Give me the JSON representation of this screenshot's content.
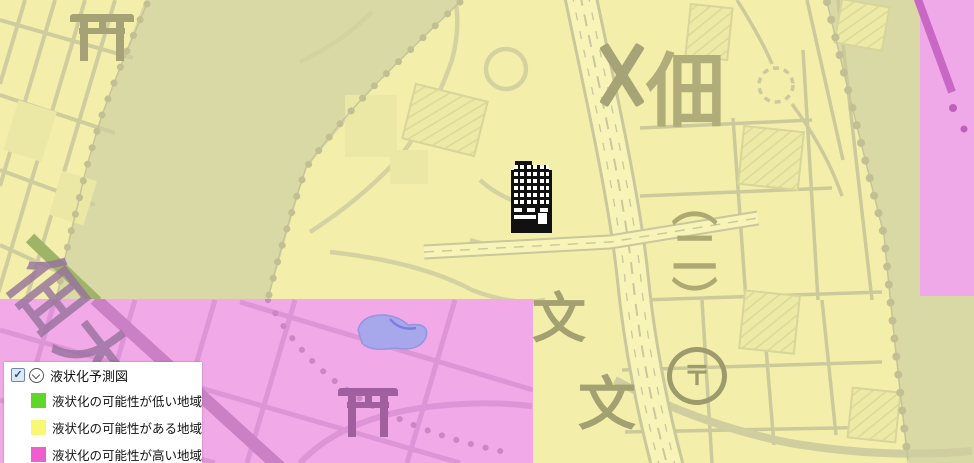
{
  "map": {
    "labels": {
      "district": "佃",
      "chome": "（二）",
      "bridge": "佃大",
      "school": "文",
      "post": "〒"
    },
    "icons": {
      "shrine": "torii-gate",
      "police_box": "x-cross",
      "post_office": "circled-postal-mark",
      "building_marker": "black-building-pictogram"
    },
    "colors": {
      "zone_possible_yellow": "#f3efab",
      "zone_high_pink": "#f1a9e7",
      "river_olive": "#d9d9a6",
      "road_line": "#ccc99b",
      "symbol_olive": "#a6a376",
      "pond_blue": "#a7a7ec"
    }
  },
  "legend": {
    "title": "液状化予測図",
    "checkbox_checked": true,
    "check_glyph": "✓",
    "items": [
      {
        "label": "液状化の可能性が低い地域",
        "color": "#5fd629"
      },
      {
        "label": "液状化の可能性がある地域",
        "color": "#f8f875"
      },
      {
        "label": "液状化の可能性が高い地域",
        "color": "#ed5ecf"
      }
    ]
  }
}
